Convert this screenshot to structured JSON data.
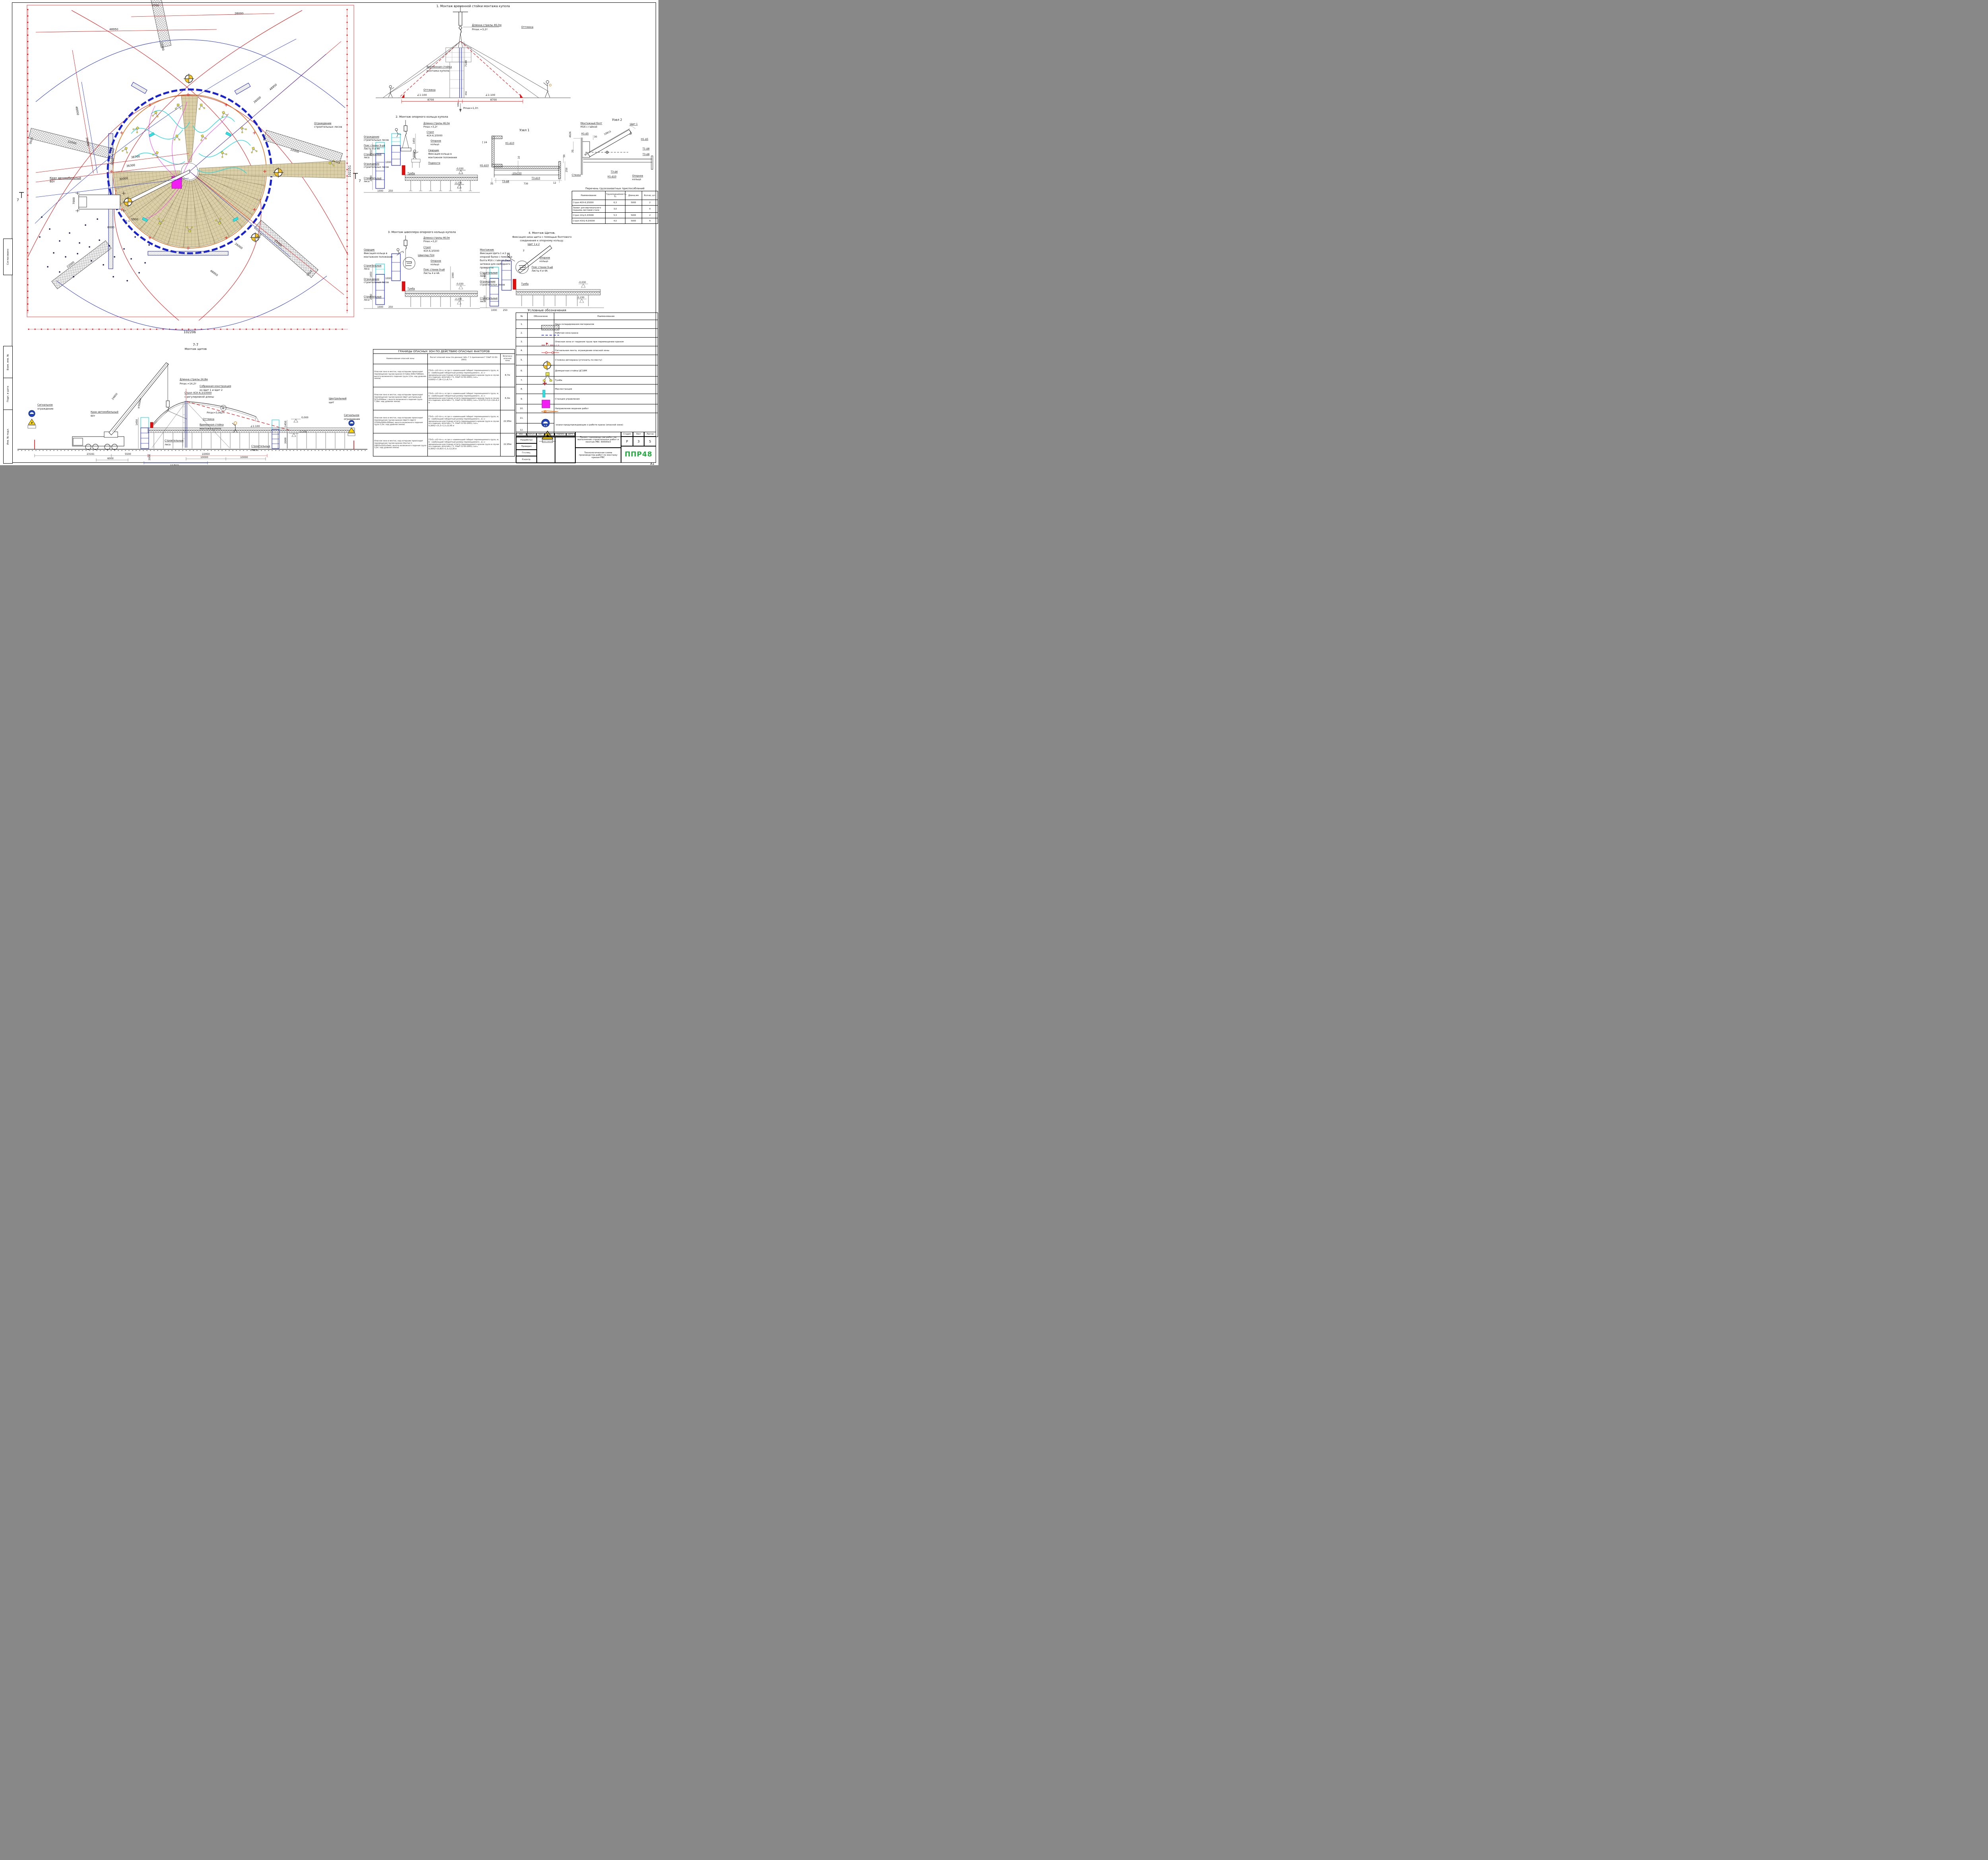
{
  "sheet": {
    "format": "А1"
  },
  "side_stamps": {
    "s1": "Согласовано",
    "s2": "Взам. инв. №",
    "s3": "Подп. и дата",
    "s4": "Инв. № подл."
  },
  "plan": {
    "crane1": "Кран автомобильный",
    "crane2": "60т",
    "station": "Ст.1",
    "section_mark": "7",
    "fence1": "Ограждение",
    "fence2": "строительных лесов",
    "dims": {
      "d48950": "48950",
      "d26000": "26000",
      "d30000": "30000",
      "d38700": "38700",
      "d36300": "36300",
      "d22000": "22000",
      "d3700": "3700",
      "d2050": "2050",
      "d7000": "7000",
      "d6000": "6000",
      "d5500": "5500",
      "d102206": "102206",
      "d102251": "102251"
    }
  },
  "stage1": {
    "title": "1. Монтаж временной стойки монтажа купола",
    "boom": "Длинна стрелы 46,0м",
    "pmax": "Pmax.=3,2т",
    "guy": "Оттяжка",
    "stand1": "Временная стойка",
    "stand2": "монтажа купола",
    "slope": "1:100",
    "d8700": "8700",
    "d640": "640",
    "d7180": "7180",
    "d456": "456",
    "pmax_ground": "Pmax=1,0т."
  },
  "stage2": {
    "title": "2. Монтаж опорного кольца купола",
    "boom": "Длинна стрелы 46,0м",
    "pmax": "Pmax.=3,2т",
    "sling1": "Строп",
    "sling2": "4СК-6,3/5000",
    "ring1": "Опорное",
    "ring2": "кольцо",
    "welder1": "Сварщик",
    "welder2": "Фиксация кольца в",
    "welder3": "монтажном положении",
    "podmosti": "Подмости",
    "fence1": "Ограждение",
    "fence2": "строительных лесов",
    "poyas1": "Пояс стенки 9-ый",
    "poyas2": "Листы 4 и 4А",
    "lesa1": "Строительные",
    "lesa2": "леса",
    "tumba": "Тумба",
    "d1450": "1450",
    "d2000": "2000",
    "d1000": "1000",
    "d250": "250",
    "lvl0": "-0,030",
    "lvl2": "-2,230"
  },
  "uzel1": {
    "title": "Узел 1",
    "ch24": "[ 24",
    "w_n1d10": "Н1-Δ10",
    "w_t3d8": "Т3-Δ8",
    "w_t3d10": "Т3-Δ10",
    "plate": "-10x150",
    "d10": "10",
    "d50": "50",
    "d250": "250",
    "d35": "35",
    "d730": "730",
    "d12": "12"
  },
  "uzel2": {
    "title": "Узел 2",
    "bolt1": "Монтажный болт",
    "bolt2": "М16 с гайкой",
    "shield": "Щит 1",
    "w_n1d5": "Н1-Δ5",
    "w_t1d8": "Т1-Δ8",
    "w_t3d8": "Т3-Δ8",
    "w_t3d6": "Т3-Δ6",
    "w_n1d10": "Н1-Δ10",
    "wall": "Стенка",
    "ring1": "Опорное",
    "ring2": "кольцо",
    "d4926": "4926",
    "d30": "30",
    "d10815": "10815",
    "d20": "20",
    "d80": "80*"
  },
  "rig_table": {
    "title": "Перечень грузозахватных приспособлений",
    "h_name": "Наименование",
    "h_cap": "Грузоподъемность, Тс",
    "h_len": "Длина,мм",
    "h_qty": "Кол-во, шт.",
    "rows": [
      {
        "name": "Строп 4СК-6,3/5000",
        "cap": "6,3",
        "len": "5000",
        "qty": "2"
      },
      {
        "name": "Захват для вертикального подъема листовой стали",
        "cap": "3,0",
        "len": "",
        "qty": "4"
      },
      {
        "name": "Строп 1СЦ-5,3/5000",
        "cap": "5,3",
        "len": "5000",
        "qty": "2"
      },
      {
        "name": "Строп УСК2-4,0/5000",
        "cap": "4,0",
        "len": "5000",
        "qty": "4"
      }
    ]
  },
  "stage3": {
    "title": "3. Монтаж швеллера опорного кольца купола",
    "boom": "Длинна стрелы 46,0м",
    "pmax": "Pmax.=3,2т",
    "sling1": "Строп",
    "sling2": "4СК-6,3/5000",
    "channel": "Швеллер П24",
    "welder1": "Сварщик",
    "welder2": "Фиксация кольца в",
    "welder3": "монтажном положении",
    "ring1": "Опорное",
    "ring2": "кольцо",
    "poyas1": "Пояс стенки 9-ый",
    "poyas2": "Листы 4 и 4А",
    "tumba": "Тумба",
    "fence1": "Ограждение",
    "fence2": "строительных лесов",
    "lesa1": "Строительные",
    "lesa2": "леса",
    "marker": "1",
    "d1990": "1990",
    "d1450": "1450",
    "d2000": "2000",
    "d1000": "1000",
    "d250": "250",
    "lvl0": "-0,030",
    "lvl2": "-2,230"
  },
  "stage4": {
    "t1": "4. Монтаж Щитов.",
    "t2": "Фиксация низа щита с помощью болтового",
    "t3": "соединения к опорному кольцу.",
    "m1": "Монтажник",
    "m2": "Фиксация Щита 1 и 2 на",
    "m3": "опорной балке с помощью",
    "m4": "болта М16 с гайкой (без",
    "m5": "затяжки для свободного",
    "m6": "проворота)",
    "shield": "Щит 1 и 2",
    "marker": "2",
    "ring1": "Опорное",
    "ring2": "кольцо",
    "poyas1": "Пояс стенки 9-ый",
    "poyas2": "Листы 4 и 4А",
    "tumba": "Тумба",
    "lesa1": "Строительные",
    "lesa2": "леса",
    "fence1": "Ограждение",
    "fence2": "строительных лесов",
    "d1450": "1450",
    "d2000": "2000",
    "d1000": "1000",
    "d250": "250",
    "lvl0": "-0,030",
    "lvl2": "-2,230"
  },
  "legend": {
    "title": "Условные обозначения",
    "h_num": "№",
    "h_sym": "Обозначене",
    "h_name": "Наименование",
    "note_11_12": "-знаки предупреждающие о работе крана (опасной зоне)",
    "sign_text": "ОСТОРОЖНО! РАБОТАЕТ КРАН",
    "rows": [
      {
        "num": "1.",
        "name": "Зона складирования материалов"
      },
      {
        "num": "2.",
        "name": "Рабочая зона крана"
      },
      {
        "num": "3.",
        "name": "Опасная зона от падения груза при перемещении краном"
      },
      {
        "num": "4.",
        "name": "Сигнальная лента, ограждение опасной зоны"
      },
      {
        "num": "5.",
        "name": "Стоянка автокрана (уточнить по месту)"
      },
      {
        "num": "6.",
        "name": "Домкратная стойка ЦС18М"
      },
      {
        "num": "7.",
        "name": "Тумба"
      },
      {
        "num": "8.",
        "name": "Маслостанция"
      },
      {
        "num": "9.",
        "name": "Станция управления"
      },
      {
        "num": "10.",
        "name": "Направление ведения работ"
      },
      {
        "num": "11.",
        "name": ""
      },
      {
        "num": "12.",
        "name": ""
      }
    ]
  },
  "danger_table": {
    "title": "ГРАНИЦЫ ОПАСНЫХ ЗОН ПО ДЕЙСТВИЮ ОПАСНЫХ ФАКТОРОВ",
    "h1": "Наименование опасной зоны",
    "h2": "Расчет опасной зоны (по данным табл. Г.1 приложения Г СНиП 12-03-2001)",
    "h3": "Величина опасной зоны",
    "rows": [
      {
        "name": "Опасная зона в местах, над которыми происходит перемещение грузов краном (Стойка 640х7180мм), высота возможного падения груза 3,2м. над уровнем земли)",
        "calc": "ГОз2= а\\2+b+х, м  где а -наименьший габарит перемещаемого груза, м; b - наибольший габаритный размер перемещаемого , м; х - минимальное расстояние отлета перемещаемого краном груза в случае его падения, м(потабл. Г1, СНиП 12-03-2001); Lоз= 0,640\\2+7,18+1,2=8,7 м",
        "val": "8,7м"
      },
      {
        "name": "Опасная зона в местах, над которыми происходит перемещение грузов краном (Щит центральный 527х3200мм ), высота возможного падения груза 7,18м. над уровнем земли)",
        "calc": "ГОз2= а\\2+b+х, м  где а -наименьший габарит перемещаемого груза, м; b - наибольший габаритный размер перемещаемого , м; х - минимальное расстояние отлета перемещаемого краном груза в случае его падения, м(потабл. Г1, СНиП 12-03-2001); Lоз= 0,527\\2+3,2+2,8=6,3 м",
        "val": "6,3м"
      },
      {
        "name": "Опасная зона в местах, над которыми происходит перемещение грузов краном (Щит1+Щит2 21500х5000х300мм), высота возможного падения груза 3,2м. над уровнем земли)",
        "calc": "ГОз2= а\\2+b+х, м  где а -наименьший габарит перемещаемого груза, м; b - наибольший габаритный размер перемещаемого , м; х - минимальное расстояние отлета перемещаемого краном груза в случае его падения, м(потабл. Г1, СНиП 12-03-2001); Lоз= 0,300\\2+21,5+1,3=22,95 м",
        "val": "22,95м"
      },
      {
        "name": "Опасная зона в местах, над которыми происходит перемещение грузов краном (Настил 1 10815х3241х5мм), высота возможного падения груза 3,2м. над уровнем земли)",
        "calc": "ГОз2= а\\2+b+х, м  где а -наименьший габарит перемещаемого груза, м; b - наибольший габаритный размер перемещаемого , м; х - минимальное расстояние отлета перемещаемого краном груза в случае его падения, м(потабл. Г1, СНиП 12-03-2001); Lоз= 0,300\\2+10,815+1,3=12,26 м",
        "val": "22,95м"
      }
    ]
  },
  "section77": {
    "title": "7-7",
    "subtitle": "Монтаж щитов",
    "boom_len": "Длинна стрелы 24,8м",
    "pmax": "Pmax.=14,2т",
    "sling1": "Строп 4СК-6,3/10000",
    "sling2": "с регулировкой длины",
    "assembled1": "Собранная конструкция",
    "assembled2": "из Щит 1 и Щит 2",
    "central1": "Центральный",
    "central2": "щит",
    "guy": "Оттяжка",
    "stand1": "Временная стойка",
    "stand2": "монтажа купола",
    "pmax_load": "Pmax=3,062т.",
    "min500": "≥500мм",
    "marker": "В",
    "crane1": "Кран автомобильный",
    "crane2": "60т",
    "signal1": "Сигнальное",
    "signal2": "ограждение",
    "lesa1": "Строительные",
    "lesa2": "леса",
    "slope": "1:100",
    "lvl0": "0,000",
    "lvl2": "-2,230",
    "d24800": "24800",
    "d23191": "23191",
    "d6000": "6000",
    "d5500": "5500",
    "d2000": "2000",
    "d11763": "11763",
    "d22950": "22950",
    "d10000": "10000",
    "d1450": "1450"
  },
  "titleblock": {
    "c1": "Изм.",
    "c2": "Кол.уч",
    "c3": "Лист",
    "c4": "№док.",
    "c5": "Подпись",
    "c6": "Дата",
    "r1": "Разработал",
    "r2": "Проверил",
    "r3": "Гл.спец.",
    "r4": "Н.контр.",
    "doc_title": "Проект производства работ на выполнение строительных работ и монтаж РВС 30000м3",
    "sheet_title": "Технологическая схема производства работ по монтажу крыши РВС",
    "stage_h": "Стадия",
    "list_h": "Лист",
    "lists_h": "Листов",
    "stage": "Р",
    "list": "3",
    "lists": "5",
    "logo": "ППР48"
  }
}
